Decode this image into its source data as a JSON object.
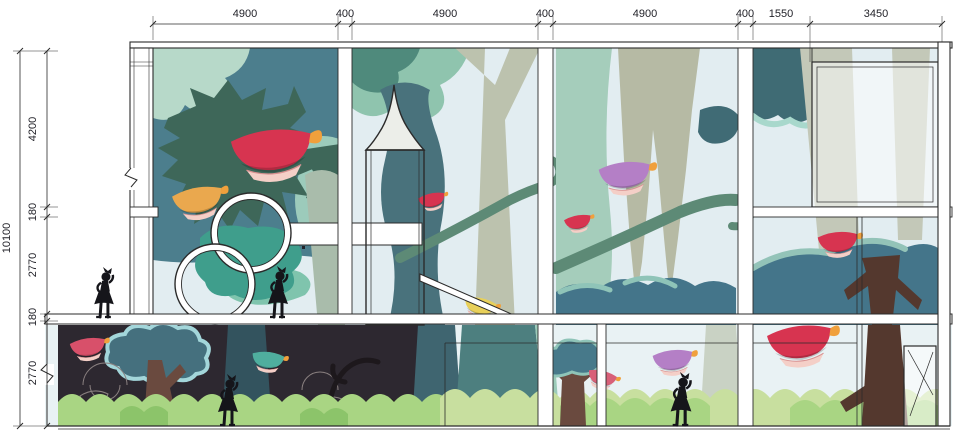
{
  "drawing": {
    "kind": "architectural-elevation-with-forest-mural",
    "mural_elements": [
      "flying-teacup",
      "forest-tree",
      "tree-canopy",
      "girl-silhouette",
      "spire-tower",
      "round-porthole-windows",
      "walkway-bridge",
      "slide-ramp",
      "bushes",
      "vine-swirls",
      "door"
    ]
  },
  "dims": {
    "top": [
      "4900",
      "400",
      "4900",
      "400",
      "4900",
      "400",
      "1550",
      "3450"
    ],
    "left_total": "10100",
    "left_segments": [
      "4200",
      "180",
      "2770",
      "180",
      "2770"
    ]
  },
  "palette": {
    "line": "#2b2b2b",
    "sky": "#e2edf1",
    "sky_light": "#e9f2f4",
    "bay1_bg": "#4c7e8d",
    "canopy_dark": "#3e6759",
    "canopy_slate": "#44758a",
    "canopy_teal": "#3f9e8c",
    "teal_deep": "#3f6b74",
    "mint_light": "#b7d9c9",
    "mint": "#8fc4ae",
    "mint2": "#9ccbbb",
    "green_deep": "#4f8a7c",
    "trunk_pale": "#bcc2ae",
    "trunk_sage": "#a5cdbb",
    "trunk_gray": "#a9bcab",
    "trunk_lightgray": "#c3c8b8",
    "trunk_teal_dark": "#49727c",
    "teal_trunk": "#4d7f7f",
    "teal_trunk2": "#3f6570",
    "vine": "#5d8a76",
    "cup_red": "#d73450",
    "cup_red_soft": "#d8506a",
    "cup_orange": "#eaa84e",
    "cup_yellow": "#e8d05a",
    "cup_purple": "#b47fc6",
    "cup_pink": "#d86078",
    "cup_teal": "#4fae9e",
    "saucer": "#f4cfc7",
    "handle_orange": "#f0a03c",
    "dark_bg": "#2d2830",
    "dark_trunk": "#33535e",
    "outline_tree_fill": "#45707e",
    "outline_tree_stroke": "#a3d6da",
    "brown_trunk": "#6a4a3f",
    "brown_dark": "#54382e",
    "bush_light": "#c8df9f",
    "bush_mid": "#a9d583",
    "bush_dark": "#8cc46a",
    "swirl": "#8a8080",
    "silhouette": "#15151a",
    "spire_fill": "#eceee9"
  }
}
